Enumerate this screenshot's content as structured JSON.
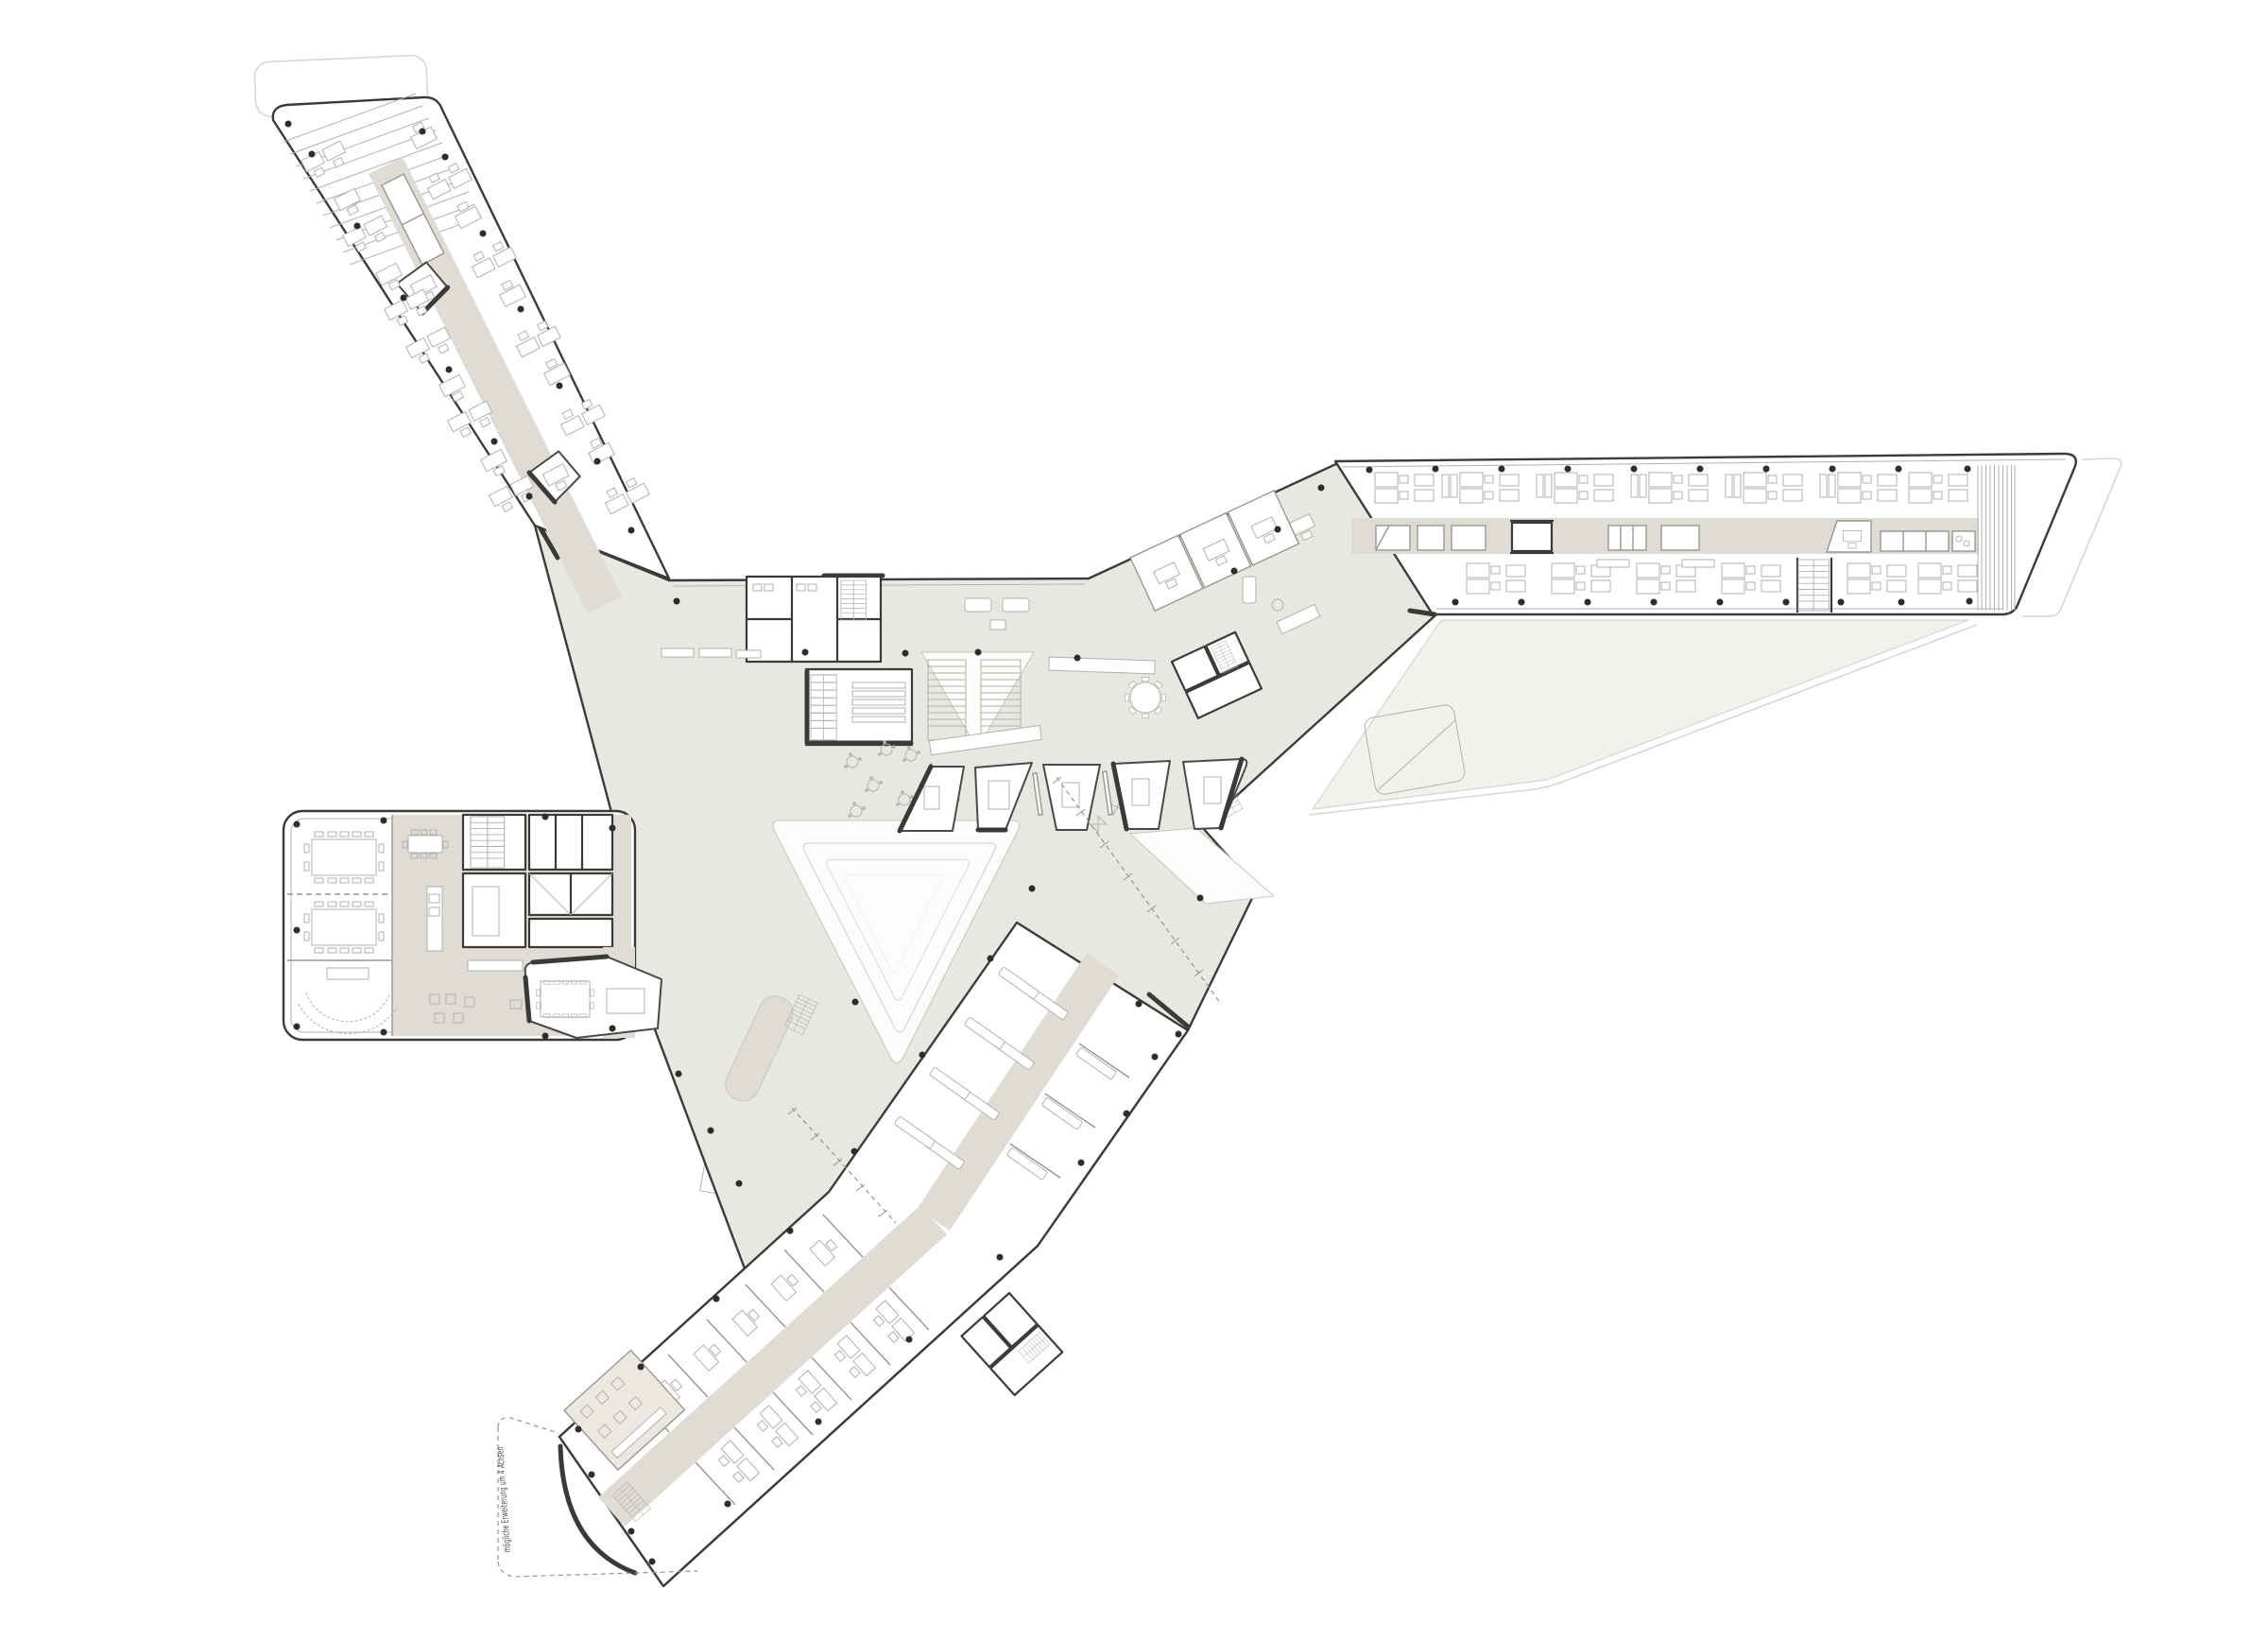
{
  "document": {
    "kind": "architectural floor plan",
    "description": "pinwheel office building with three bar wings, a conference block and a central atrium hall"
  },
  "annotations": {
    "extension_note": "mögliche Erweiterung um 4 Achsen"
  },
  "palette": {
    "background": "#ffffff",
    "slab_outline": "#3c3b39",
    "plaza_fill": "#e9e7e2",
    "corridor_fill": "#dedcd5",
    "terrace_fill": "#f2f1ee",
    "faint_line": "#d8d6d1",
    "furniture_line": "#b3b1ab",
    "partition_line": "#98968f",
    "dark_wall": "#3b3a38",
    "column_dot": "#2e2d2b",
    "text_color": "#4a4947"
  },
  "regions": [
    "northwest-wing",
    "east-wing",
    "south-wing",
    "west-conference-block",
    "central-hall",
    "atrium-void",
    "meeting-pods",
    "roof-terrace",
    "possible-extension"
  ]
}
